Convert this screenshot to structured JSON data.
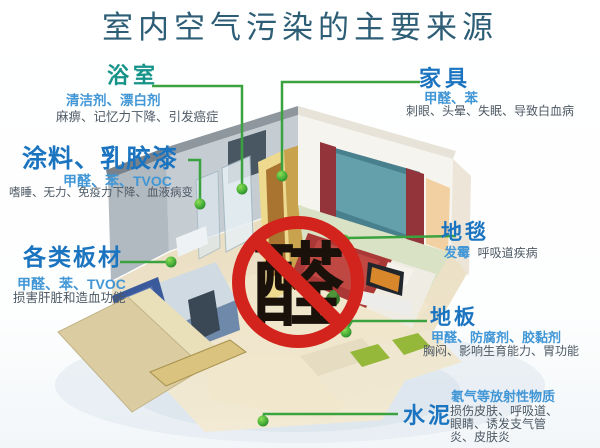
{
  "title": "室内空气污染的主要来源",
  "ban_sign": {
    "character": "醛",
    "meaning": "formaldehyde-prohibited"
  },
  "labels": {
    "bathroom": {
      "name": "浴室",
      "pollutants": "清洁剂、漂白剂",
      "effects": "麻痹、记忆力下降、引发癌症"
    },
    "paint": {
      "name": "涂料、乳胶漆",
      "pollutants": "甲醛、苯、TVOC",
      "effects": "嗜睡、无力、免疫力下降、血液病变"
    },
    "boards": {
      "name": "各类板材",
      "pollutants": "甲醛、苯、TVOC",
      "effects": "损害肝脏和造血功能"
    },
    "furniture": {
      "name": "家具",
      "pollutants": "甲醛、苯",
      "effects": "刺眼、头晕、失眠、导致白血病"
    },
    "carpet": {
      "name": "地毯",
      "pollutants": "发霉",
      "effects": "呼吸道疾病"
    },
    "floor": {
      "name": "地板",
      "pollutants": "甲醛、防腐剂、胶黏剂",
      "effects": "胸闷、影响生育能力、胃功能"
    },
    "cement": {
      "name": "水泥",
      "pollutants": "氡气等放射性物质",
      "effects": "损伤皮肤、呼吸道、眼睛、诱发支气管炎、皮肤炎"
    }
  },
  "colors": {
    "title": "#2d5e76",
    "header_blue": "#1b74c0",
    "header_teal": "#17948a",
    "pollutant_blue": "#4196d6",
    "effect_gray": "#4d5964",
    "connector_green": "#3aa33f",
    "ban_red": "#d2241c"
  }
}
